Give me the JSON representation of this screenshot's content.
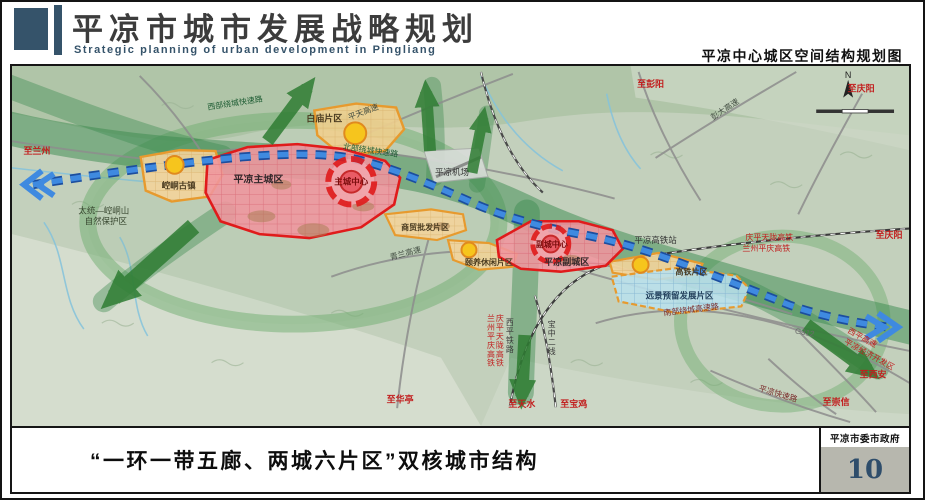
{
  "header": {
    "title": "平凉市城市发展战略规划",
    "subtitle": "Strategic planning of urban development in Pingliang",
    "map_title": "平凉中心城区空间结构规划图"
  },
  "footer": {
    "caption": "“一环一带五廊、两城六片区”双核城市结构",
    "agency": "平凉市委市政府",
    "page_number": "10"
  },
  "map": {
    "compass_label": "N",
    "labels": [
      {
        "text": "至兰州",
        "x": 25,
        "y": 89,
        "size": 9,
        "color": "#c21d1d",
        "bold": true
      },
      {
        "text": "西部绕城快速路",
        "x": 224,
        "y": 40,
        "size": 8,
        "color": "#1d5c33",
        "rotate": -9
      },
      {
        "text": "白庙片区",
        "x": 313,
        "y": 56,
        "size": 9,
        "color": "#4a3b20",
        "bold": true
      },
      {
        "text": "平天高速",
        "x": 353,
        "y": 49,
        "size": 8,
        "color": "#3f4a3f",
        "rotate": -21
      },
      {
        "text": "北部绕城快速路",
        "x": 359,
        "y": 88,
        "size": 8,
        "color": "#1d5c33",
        "rotate": 8
      },
      {
        "text": "至彭阳",
        "x": 640,
        "y": 21,
        "size": 9,
        "color": "#c21d1d",
        "bold": true
      },
      {
        "text": "彭大高速",
        "x": 716,
        "y": 46,
        "size": 8,
        "color": "#3f4a3f",
        "rotate": -34
      },
      {
        "text": "至庆阳",
        "x": 851,
        "y": 26,
        "size": 9,
        "color": "#c21d1d",
        "bold": true
      },
      {
        "text": "平凉机场",
        "x": 441,
        "y": 110,
        "size": 8.5,
        "color": "#333333"
      },
      {
        "text": "崆峒古镇",
        "x": 167,
        "y": 124,
        "size": 8.5,
        "color": "#4a3b20",
        "bold": true
      },
      {
        "text": "平凉主城区",
        "x": 247,
        "y": 118,
        "size": 10,
        "color": "#33272a",
        "bold": true
      },
      {
        "text": "主城中心",
        "x": 340,
        "y": 120,
        "size": 8.5,
        "color": "#7a0c0c",
        "bold": true
      },
      {
        "text": "太统—崆峒山",
        "x": 92,
        "y": 149,
        "size": 8.5,
        "color": "#37462f"
      },
      {
        "text": "自然保护区",
        "x": 94,
        "y": 160,
        "size": 8.5,
        "color": "#37462f"
      },
      {
        "text": "青兰高速",
        "x": 395,
        "y": 192,
        "size": 8,
        "color": "#3f4a3f",
        "rotate": -15
      },
      {
        "text": "商贸批发片区",
        "x": 414,
        "y": 166,
        "size": 8,
        "color": "#4a3b20",
        "bold": true
      },
      {
        "text": "颐养休闲片区",
        "x": 478,
        "y": 201,
        "size": 8,
        "color": "#4a3b20",
        "bold": true
      },
      {
        "text": "副城中心",
        "x": 541,
        "y": 183,
        "size": 8,
        "color": "#7a0c0c",
        "bold": true
      },
      {
        "text": "平凉副城区",
        "x": 556,
        "y": 201,
        "size": 9,
        "color": "#33272a",
        "bold": true
      },
      {
        "text": "平凉高铁站",
        "x": 645,
        "y": 179,
        "size": 8.5,
        "color": "#333333"
      },
      {
        "text": "高铁片区",
        "x": 681,
        "y": 211,
        "size": 8,
        "color": "#4a3b20",
        "bold": true
      },
      {
        "text": "远景预留发展片区",
        "x": 669,
        "y": 235,
        "size": 8.5,
        "color": "#23405c",
        "bold": true
      },
      {
        "text": "庆平天陇高铁",
        "x": 759,
        "y": 176,
        "size": 8,
        "color": "#c21d1d"
      },
      {
        "text": "兰州平庆高铁",
        "x": 756,
        "y": 187,
        "size": 8,
        "color": "#c21d1d"
      },
      {
        "text": "至庆阳",
        "x": 879,
        "y": 174,
        "size": 9,
        "color": "#c21d1d",
        "bold": true
      },
      {
        "text": "G312",
        "x": 794,
        "y": 272,
        "size": 8,
        "color": "#6b6b6b",
        "rotate": 10
      },
      {
        "text": "南部绕城高速路",
        "x": 681,
        "y": 249,
        "size": 8,
        "color": "#7a2a2a",
        "rotate": -7
      },
      {
        "text": "西平高速",
        "x": 851,
        "y": 277,
        "size": 8,
        "color": "#c21d1d",
        "rotate": 29
      },
      {
        "text": "平凉经济开发区",
        "x": 858,
        "y": 294,
        "size": 8,
        "color": "#c21d1d",
        "rotate": 29
      },
      {
        "text": "至西安",
        "x": 863,
        "y": 315,
        "size": 9,
        "color": "#c21d1d",
        "bold": true
      },
      {
        "text": "平凉快速路",
        "x": 767,
        "y": 334,
        "size": 8,
        "color": "#7a2a2a",
        "rotate": 17
      },
      {
        "text": "至崇信",
        "x": 826,
        "y": 343,
        "size": 9,
        "color": "#c21d1d",
        "bold": true
      },
      {
        "text": "至华亭",
        "x": 389,
        "y": 340,
        "size": 9,
        "color": "#c21d1d",
        "bold": true
      },
      {
        "text": "至天水",
        "x": 511,
        "y": 345,
        "size": 9,
        "color": "#c21d1d",
        "bold": true
      },
      {
        "text": "至宝鸡",
        "x": 563,
        "y": 345,
        "size": 9,
        "color": "#c21d1d",
        "bold": true
      },
      {
        "text": "兰州平庆高铁",
        "x": 480,
        "y": 258,
        "size": 8,
        "color": "#c21d1d",
        "vertical": true
      },
      {
        "text": "庆平天陇高铁",
        "x": 489,
        "y": 258,
        "size": 8,
        "color": "#c21d1d",
        "vertical": true
      },
      {
        "text": "西平铁路",
        "x": 499,
        "y": 262,
        "size": 8,
        "color": "#3a3a3a",
        "vertical": true
      },
      {
        "text": "宝中二线",
        "x": 541,
        "y": 264,
        "size": 8,
        "color": "#3a3a3a",
        "vertical": true
      }
    ]
  },
  "colors": {
    "accent_slate": "#35536a",
    "page_number_blue": "#2e4d6b",
    "core_red": "#e01b1b",
    "zone_pink": "#f0959e",
    "zone_orange_border": "#e79a2e",
    "zone_orange_fill": "#f3d49b",
    "reserve_blue_fill": "#b9e0ed",
    "axis_blue": "#3f8ae0",
    "corridor_green": "#2f7d33",
    "label_red": "#c21d1d"
  }
}
